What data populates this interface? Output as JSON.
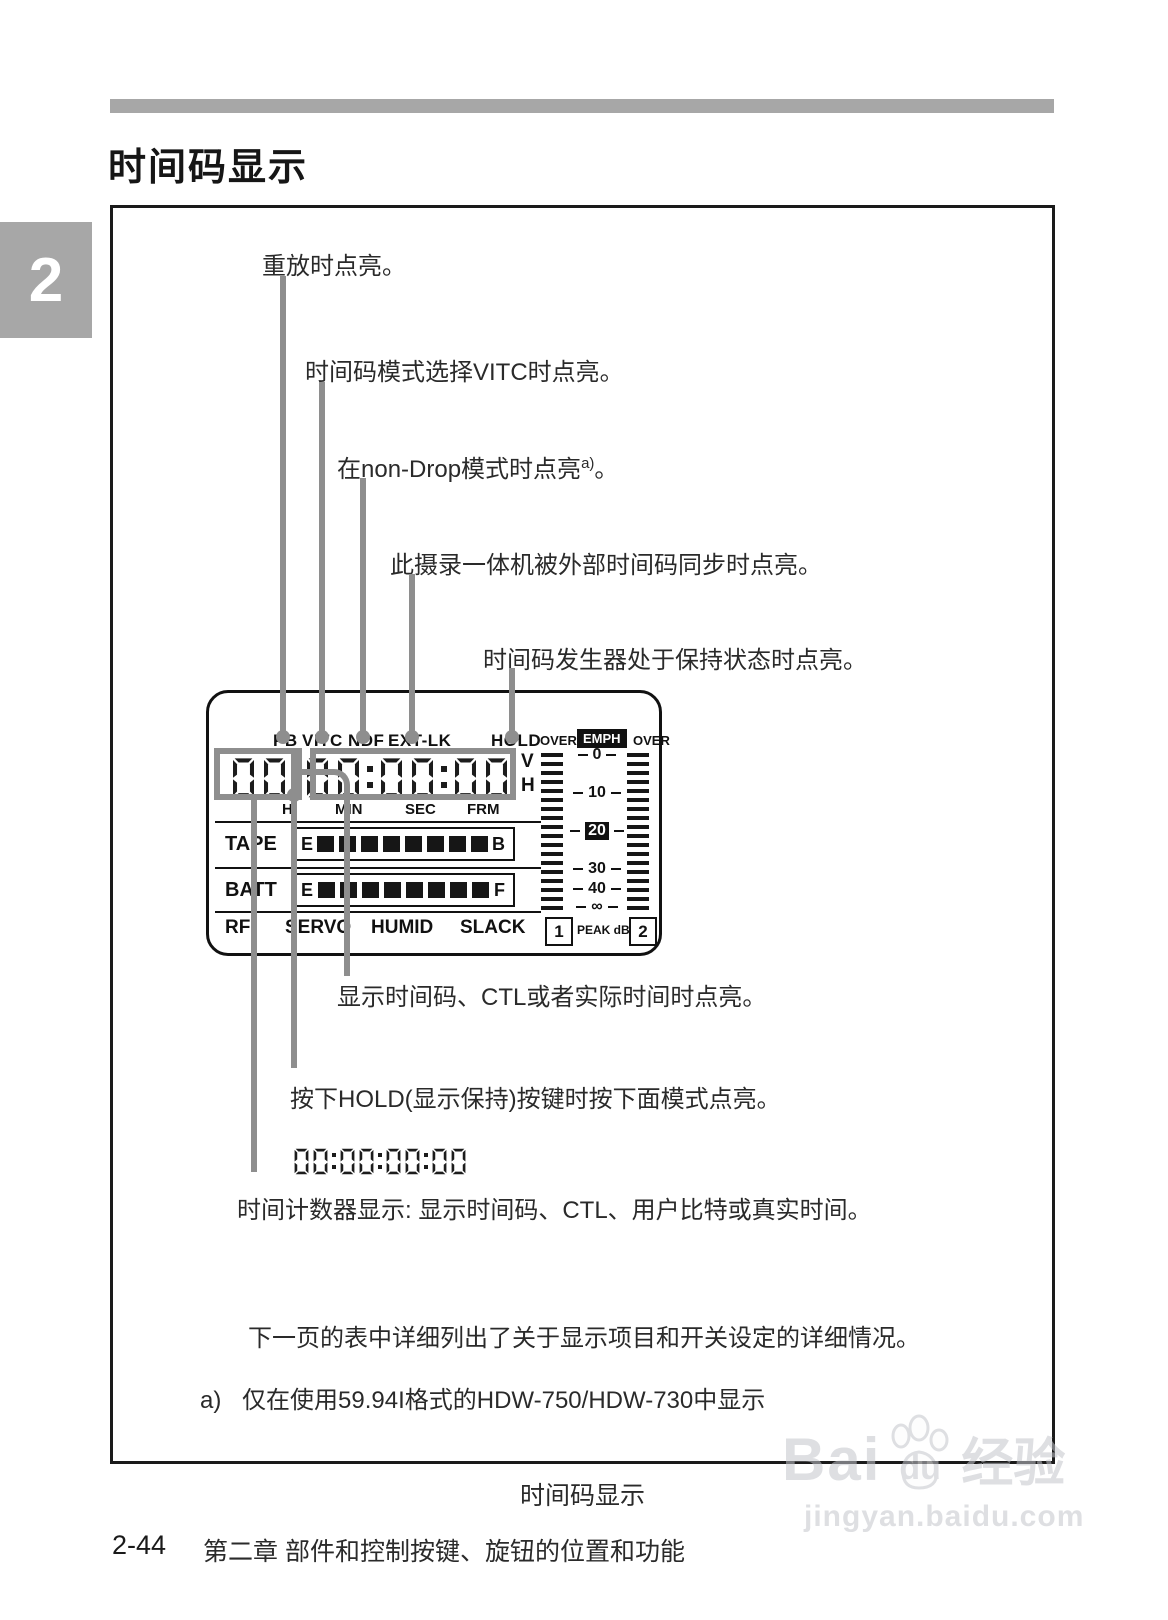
{
  "page": {
    "chapter_tab": "2",
    "title": "时间码显示",
    "caption": "时间码显示",
    "footer_page": "2-44",
    "footer_chapter": "第二章 部件和控制按键、旋钮的位置和功能",
    "watermark": {
      "brand_left": "Bai",
      "brand_right": "du",
      "brand_suffix": "经验",
      "url": "jingyan.baidu.com"
    }
  },
  "callouts": {
    "pb": "重放时点亮。",
    "vitc": "时间码模式选择VITC时点亮。",
    "ndf": "在non-Drop模式时点亮",
    "ndf_sup": "a)",
    "ndf_period": "。",
    "extlk": "此摄录一体机被外部时间码同步时点亮。",
    "hold": "时间码发生器处于保持状态时点亮。",
    "counter_lit": "显示时间码、CTL或者实际时间时点亮。",
    "hold_key": "按下HOLD(显示保持)按键时按下面模式点亮。",
    "counter_desc": "时间计数器显示:  显示时间码、CTL、用户比特或真实时间。"
  },
  "display": {
    "indicators": [
      "PB",
      "VITC",
      "NDF",
      "EXT-LK",
      "HOLD"
    ],
    "timecode": "00:00:00:00",
    "units": [
      "H",
      "MIN",
      "SEC",
      "FRM"
    ],
    "fields": [
      "V",
      "H"
    ],
    "tape": {
      "label": "TAPE",
      "from": "E",
      "to": "B",
      "segments": 8
    },
    "batt": {
      "label": "BATT",
      "from": "E",
      "to": "F",
      "segments": 8
    },
    "status": [
      "RF",
      "SERVO",
      "HUMID",
      "SLACK"
    ],
    "meter": {
      "over_left": "OVER",
      "emph": "EMPH",
      "over_right": "OVER",
      "scale": [
        "0",
        "10",
        "20",
        "30",
        "40",
        "∞"
      ],
      "inverted_tick": "20",
      "ch1": "1",
      "ch2": "2",
      "peak_label": "PEAK dB",
      "bars_per_channel": 18
    }
  },
  "hold_mode_timecode": "00:00:00:00",
  "notes": {
    "next_page": "下一页的表中详细列出了关于显示项目和开关设定的详细情况。",
    "footnote_marker": "a)",
    "footnote_text": "仅在使用59.94I格式的HDW-750/HDW-730中显示"
  }
}
